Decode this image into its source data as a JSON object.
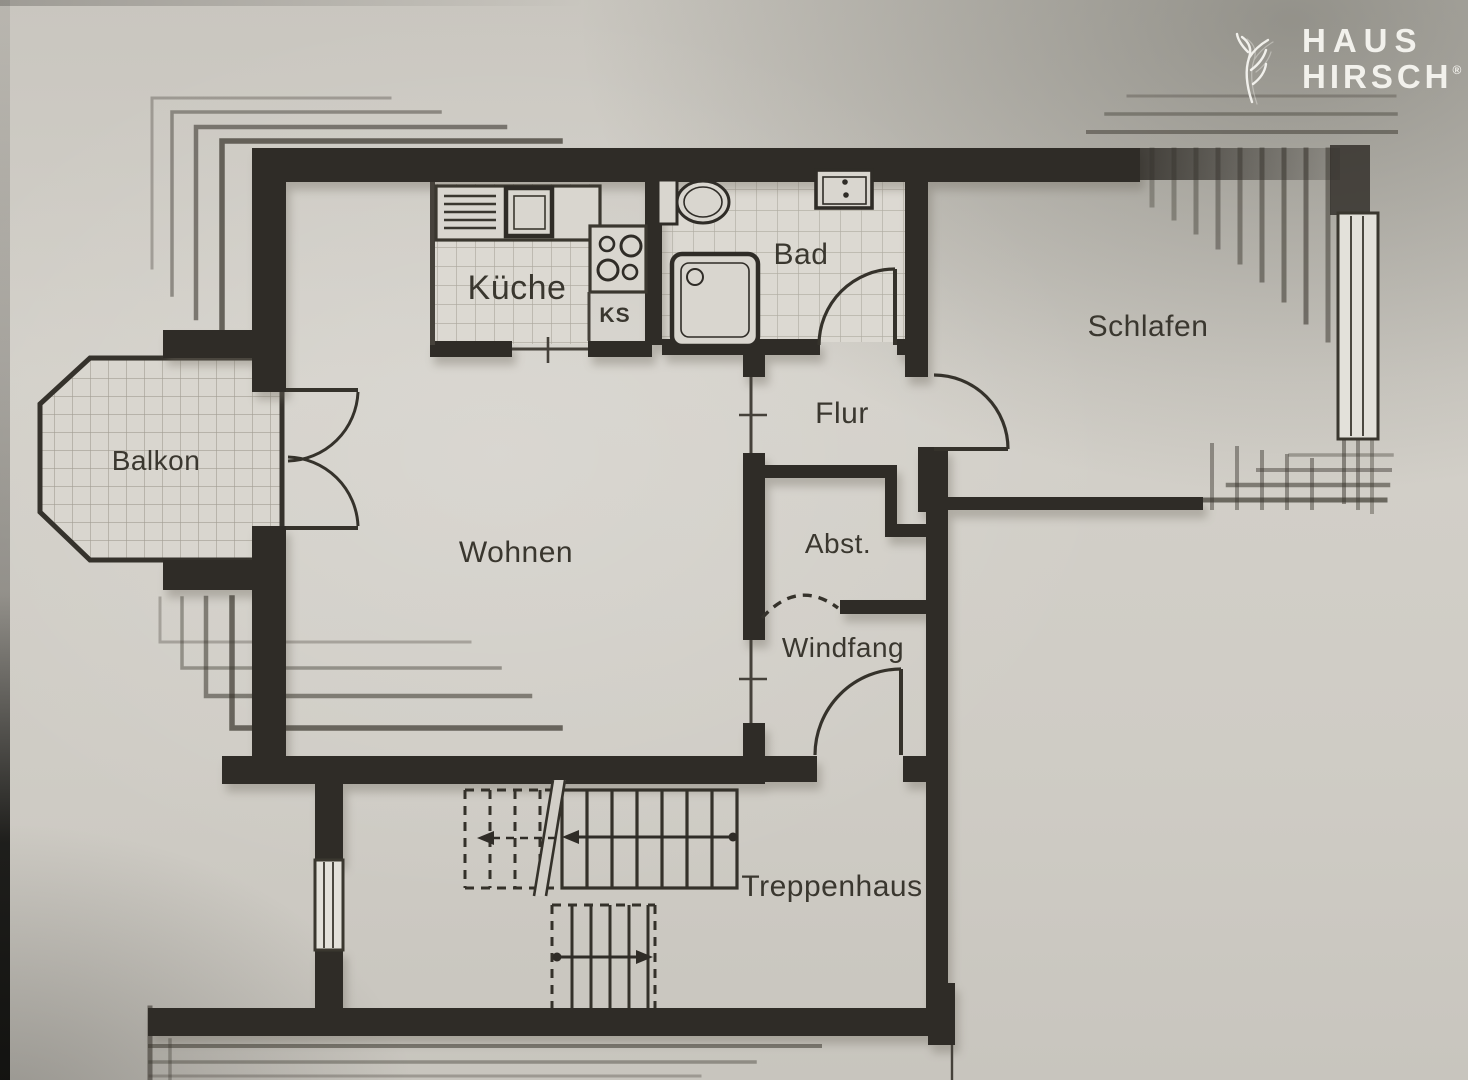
{
  "logo": {
    "line1": "HAUS",
    "line2": "HIRSCH",
    "registered": "®",
    "icon": "stag-antler-icon"
  },
  "rooms": {
    "kueche": {
      "label": "Küche"
    },
    "bad": {
      "label": "Bad"
    },
    "schlafen": {
      "label": "Schlafen"
    },
    "flur": {
      "label": "Flur"
    },
    "balkon": {
      "label": "Balkon"
    },
    "wohnen": {
      "label": "Wohnen"
    },
    "abstellraum": {
      "label": "Abst."
    },
    "windfang": {
      "label": "Windfang"
    },
    "treppenhaus": {
      "label": "Treppenhaus"
    }
  },
  "fixtures": {
    "fridge": {
      "label": "KS"
    }
  },
  "colors": {
    "paper": "#d2cfc8",
    "tile_floor": "#dcd9d2",
    "wall": "#2f2c27",
    "thin_line": "#45413a",
    "logo_text": "#f2f1ec"
  }
}
